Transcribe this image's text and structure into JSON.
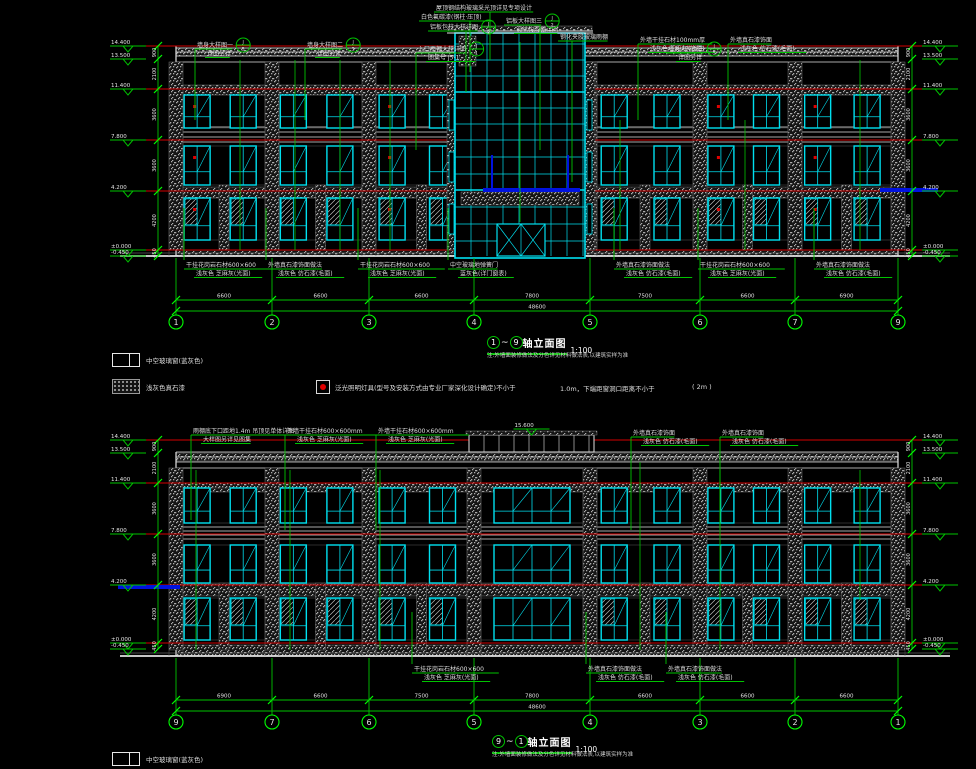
{
  "colors": {
    "bg": "#000000",
    "green": "#00c300",
    "green_bright": "#00ff00",
    "red": "#d40000",
    "cyan": "#00e0f0",
    "white": "#e2e2e2",
    "gray": "#8f8f8f",
    "dgray": "#565656",
    "blue": "#0012e0",
    "lamp_red": "#e00000",
    "text": "#dedede"
  },
  "titles": {
    "top": {
      "from": "1",
      "sep": "~",
      "to": "9",
      "text": "轴立面图",
      "scale": "1:100",
      "note": "注:外墙面装修做法及分色详见材料做法表,以建筑实样为准"
    },
    "bottom": {
      "from": "9",
      "sep": "~",
      "to": "1",
      "text": "轴立面图",
      "scale": "1:100",
      "note": "注:外墙面装修做法及分色详见材料做法表,以建筑实样为准"
    }
  },
  "legend": {
    "window_label": "中空玻璃窗(蓝灰色)",
    "paint_label": "浅灰色真石漆",
    "lamp_label": "泛光照明灯具(型号及安装方式由专业厂家深化设计确定)不小于",
    "lamp_note1": "1.0m，下端距窗洞口距离不小于",
    "lamp_note2": "( 2m )",
    "bottom_window_label": "中空玻璃窗(蓝灰色)"
  },
  "drawing": {
    "elevations": [
      {
        "id": "top",
        "facade": {
          "x1": 176,
          "x2": 898,
          "top": 46,
          "bottom": 256
        },
        "parapet_lines": [
          48,
          52,
          56,
          62
        ],
        "cornice_lines": [
          127,
          132,
          137,
          142
        ],
        "floor_lines_red": [
          46,
          89,
          140,
          191,
          250
        ],
        "hatch_bands": [
          {
            "y": 48,
            "h": 8
          },
          {
            "y": 85,
            "h": 10
          },
          {
            "y": 187,
            "h": 11
          },
          {
            "y": 250,
            "h": 6
          }
        ],
        "floors": [
          {
            "y": 95,
            "h": 33
          },
          {
            "y": 146,
            "h": 39
          },
          {
            "y": 198,
            "h": 42
          }
        ],
        "grid_x": [
          176,
          272,
          369,
          474,
          590,
          700,
          795,
          898
        ],
        "grid_labels": [
          "1",
          "2",
          "3",
          "4",
          "5",
          "6",
          "7",
          "9"
        ],
        "bay_dims": [
          "6600",
          "6600",
          "6600",
          "7800",
          "7500",
          "6600",
          "6900"
        ],
        "total_dim": "48600",
        "dim_y": 300,
        "total_y": 311,
        "bubble_y": 322,
        "levels": [
          [
            "14.400",
            46
          ],
          [
            "13.500",
            59
          ],
          [
            "11.400",
            89
          ],
          [
            "7.800",
            140
          ],
          [
            "4.200",
            191
          ],
          [
            "±0.000",
            250
          ],
          [
            "-0.450",
            256
          ]
        ],
        "vdims": [
          "900",
          "2100",
          "3600",
          "3600",
          "4200",
          "450"
        ],
        "tower": {
          "x1": 455,
          "x2": 585,
          "top": 30,
          "step": 16,
          "transoms": [
            44,
            60,
            76,
            92,
            108,
            124,
            140,
            157,
            174,
            190,
            207,
            224,
            241
          ],
          "door_y": 224,
          "canopy": {
            "x": 483,
            "w": 97,
            "y": 188,
            "posts": [
              492,
              568
            ],
            "post_top": 155
          }
        },
        "side_canopy": {
          "x": 880,
          "w": 58,
          "y": 188
        },
        "skip_bay": 3,
        "lamp_bays": [
          0,
          2,
          5,
          6
        ],
        "leads": [
          [
            240,
            60,
            250
          ],
          [
            295,
            60,
            250
          ],
          [
            340,
            60,
            250
          ],
          [
            390,
            60,
            250
          ],
          [
            520,
            42,
            222
          ],
          [
            620,
            120,
            250
          ],
          [
            745,
            120,
            250
          ],
          [
            860,
            60,
            250
          ]
        ],
        "below_text_y": 262
      },
      {
        "id": "bottom",
        "facade": {
          "x1": 176,
          "x2": 898,
          "top": 452,
          "bottom": 656
        },
        "parapet_lines": [
          452,
          457,
          462,
          468
        ],
        "cornice_lines": [
          527,
          531,
          535,
          539
        ],
        "floor_lines_red": [
          440,
          483,
          534,
          585,
          643
        ],
        "hatch_bands": [
          {
            "y": 453,
            "h": 8
          },
          {
            "y": 483,
            "h": 9
          },
          {
            "y": 584,
            "h": 12
          },
          {
            "y": 645,
            "h": 11
          }
        ],
        "floors": [
          {
            "y": 488,
            "h": 35
          },
          {
            "y": 545,
            "h": 38
          },
          {
            "y": 598,
            "h": 42
          }
        ],
        "grid_x": [
          176,
          272,
          369,
          474,
          590,
          700,
          795,
          898
        ],
        "grid_labels": [
          "9",
          "7",
          "6",
          "5",
          "4",
          "3",
          "2",
          "1"
        ],
        "bay_dims": [
          "6900",
          "6600",
          "7500",
          "7800",
          "6600",
          "6600",
          "6600"
        ],
        "total_dim": "48600",
        "dim_y": 700,
        "total_y": 711,
        "bubble_y": 722,
        "levels": [
          [
            "14.400",
            440
          ],
          [
            "13.500",
            453
          ],
          [
            "11.400",
            483
          ],
          [
            "7.800",
            534
          ],
          [
            "4.200",
            585
          ],
          [
            "±0.000",
            643
          ],
          [
            "-0.450",
            649
          ]
        ],
        "vdims": [
          "900",
          "2100",
          "3600",
          "3600",
          "4200",
          "450"
        ],
        "roof_box": {
          "x1": 469,
          "x2": 594,
          "top": 435,
          "bottom": 452,
          "step": 15,
          "level": [
            "15.600",
            429
          ]
        },
        "wide_bay": 3,
        "side_canopy": {
          "x": 118,
          "w": 62,
          "y": 585
        },
        "leads": [
          [
            196,
            470,
            650
          ],
          [
            290,
            470,
            650
          ],
          [
            380,
            470,
            650
          ],
          [
            640,
            462,
            650
          ],
          [
            720,
            462,
            650
          ],
          [
            860,
            470,
            600
          ]
        ],
        "below_text_y": 666
      }
    ],
    "annotations": {
      "top_above": [
        {
          "x": 197,
          "y": 42,
          "lines": [
            "墙身大样图一",
            "详图另详"
          ],
          "circle": true,
          "ct": "J",
          "cb": "5",
          "ly": 120
        },
        {
          "x": 307,
          "y": 42,
          "lines": [
            "墙身大样图二",
            "详图另详"
          ],
          "circle": true,
          "ct": "J",
          "cb": "5",
          "ly": 120
        },
        {
          "x": 418,
          "y": 46,
          "lines": [
            "入口雨棚大样详图",
            "图集号 J5-1"
          ],
          "circle": true,
          "ct": "J",
          "cb": "1",
          "ly": 150
        },
        {
          "x": 436,
          "y": 5,
          "lines": [
            "屋顶钢结构玻璃采光顶详见专项设计"
          ],
          "lx": 490,
          "ly": 60
        },
        {
          "x": 421,
          "y": 14,
          "lines": [
            "白色氟碳漆(钢柱·压顶)"
          ],
          "lx": 470,
          "ly": 72
        },
        {
          "x": 430,
          "y": 24,
          "lines": [
            "铝板包柱大样详图"
          ],
          "circle": true,
          "ct": "J",
          "cb": "6",
          "lx": 466,
          "ly": 92
        },
        {
          "x": 506,
          "y": 18,
          "lines": [
            "铝板大样图三",
            "钢结构雨棚详图"
          ],
          "circle": true,
          "ct": "J",
          "cb": "2",
          "lx": 540,
          "ly": 150
        },
        {
          "x": 560,
          "y": 34,
          "lines": [
            "钢化夹胶玻璃雨棚"
          ],
          "lx": 572,
          "ly": 182
        },
        {
          "x": 640,
          "y": 37,
          "lines": [
            "外墙干挂石材100mm厚",
            "浅灰色 芝麻灰(光面)"
          ],
          "ly": 120
        },
        {
          "x": 668,
          "y": 46,
          "lines": [
            "墙身大样图三",
            "详图另详"
          ],
          "circle": true,
          "ct": "J",
          "cb": "5"
        },
        {
          "x": 730,
          "y": 37,
          "lines": [
            "外墙真石漆饰面",
            "浅灰色 仿石漆(毛面)"
          ],
          "ly": 120
        }
      ],
      "top_below": [
        {
          "x": 186,
          "lines": [
            "干挂花岗岩石材600×600",
            "浅灰色 芝麻灰(光面)"
          ]
        },
        {
          "x": 268,
          "lines": [
            "外墙真石漆饰面做法",
            "浅灰色 仿石漆(毛面)"
          ]
        },
        {
          "x": 360,
          "lines": [
            "干挂花岗岩石材600×600",
            "浅灰色 芝麻灰(光面)"
          ]
        },
        {
          "x": 450,
          "lines": [
            "中空玻璃地弹簧门",
            "蓝灰色(详门窗表)"
          ]
        },
        {
          "x": 616,
          "lines": [
            "外墙真石漆饰面做法",
            "浅灰色 仿石漆(毛面)"
          ]
        },
        {
          "x": 700,
          "lines": [
            "干挂花岗岩石材600×600",
            "浅灰色 芝麻灰(光面)"
          ]
        },
        {
          "x": 816,
          "lines": [
            "外墙真石漆饰面做法",
            "浅灰色 仿石漆(毛面)"
          ]
        }
      ],
      "bottom_above": [
        {
          "x": 193,
          "y": 428,
          "lines": [
            "雨棚底下口距地1.4m 吊顶见单体详图",
            "大样图另详见图集"
          ],
          "ly": 520
        },
        {
          "x": 287,
          "y": 428,
          "lines": [
            "外墙干挂石材600×600mm",
            "浅灰色 芝麻灰(光面)"
          ],
          "ly": 530
        },
        {
          "x": 378,
          "y": 428,
          "lines": [
            "外墙干挂石材600×600mm",
            "浅灰色 芝麻灰(光面)"
          ],
          "ly": 530
        },
        {
          "x": 633,
          "y": 430,
          "lines": [
            "外墙真石漆饰面",
            "浅灰色 仿石漆(毛面)"
          ],
          "ly": 530
        },
        {
          "x": 722,
          "y": 430,
          "lines": [
            "外墙真石漆饰面",
            "浅灰色 仿石漆(毛面)"
          ],
          "ly": 530
        }
      ],
      "bottom_below": [
        {
          "x": 414,
          "lines": [
            "干挂花岗岩石材600×600",
            "浅灰色 芝麻灰(光面)"
          ]
        },
        {
          "x": 588,
          "lines": [
            "外墙真石漆饰面做法",
            "浅灰色 仿石漆(毛面)"
          ]
        },
        {
          "x": 668,
          "lines": [
            "外墙真石漆饰面做法",
            "浅灰色 仿石漆(毛面)"
          ]
        }
      ]
    }
  }
}
